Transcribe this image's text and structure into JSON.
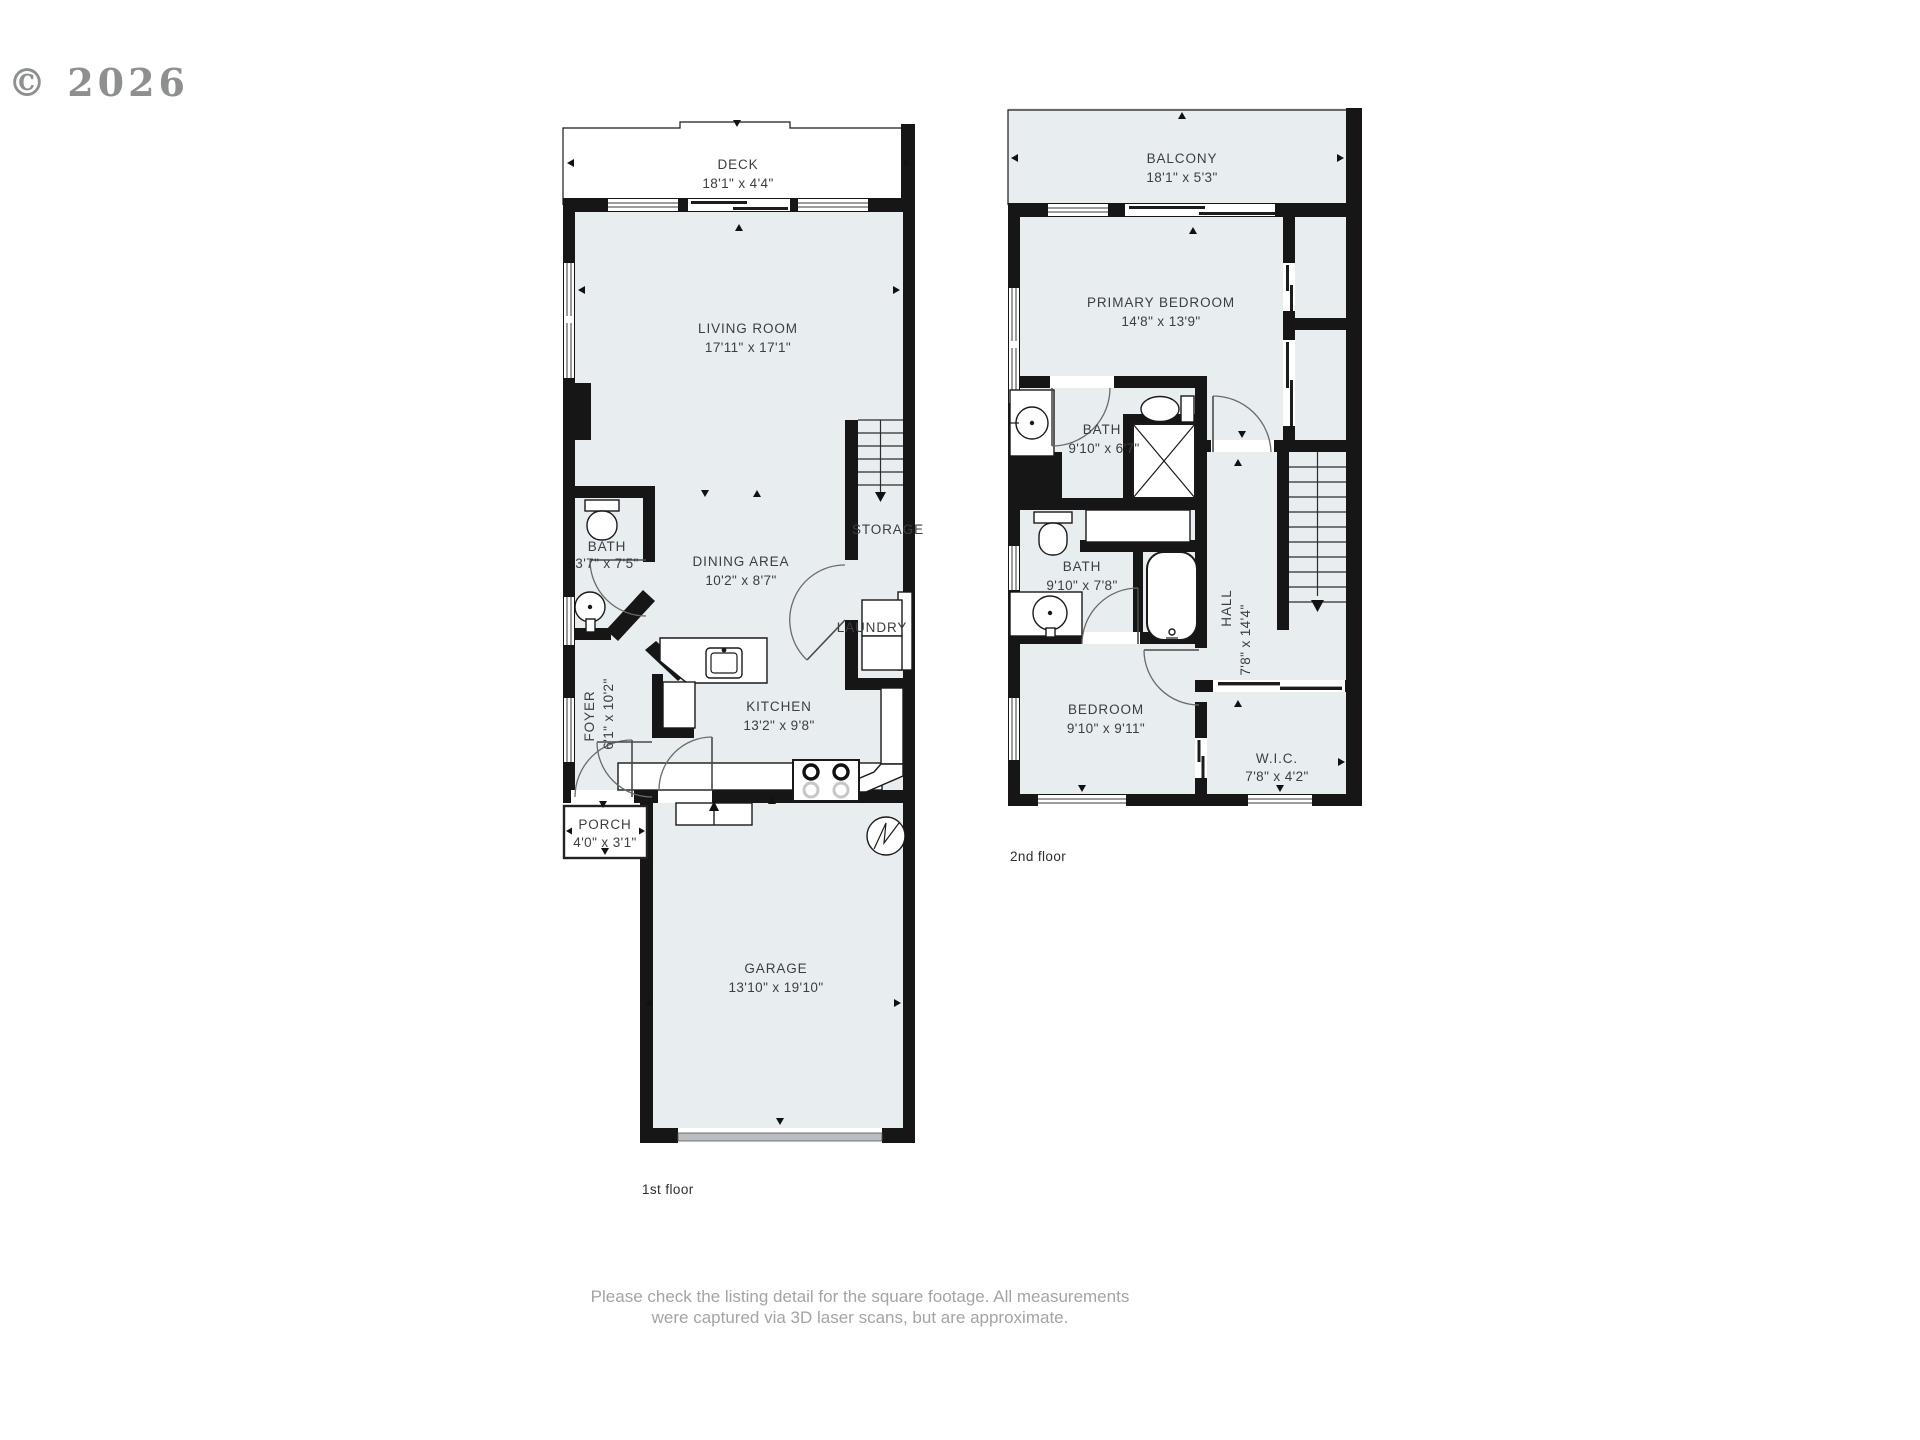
{
  "watermark": "© 2026",
  "colors": {
    "room_fill": "#e8edf0",
    "wall": "#161616",
    "label": "#3b3e42",
    "watermark": "#8d8f90",
    "disclaimer": "#a4a4a4",
    "garage_door": "#b9bdbf"
  },
  "floor1": {
    "caption": "1st floor",
    "rooms": {
      "deck": {
        "name": "DECK",
        "dims": "18'1\" x 4'4\""
      },
      "living": {
        "name": "LIVING ROOM",
        "dims": "17'11\" x 17'1\""
      },
      "bath": {
        "name": "BATH",
        "dims": "3'7\" x 7'5\""
      },
      "dining": {
        "name": "DINING AREA",
        "dims": "10'2\" x 8'7\""
      },
      "storage": {
        "name": "STORAGE"
      },
      "laundry": {
        "name": "LAUNDRY"
      },
      "foyer": {
        "name": "FOYER",
        "dims": "6'1\" x 10'2\""
      },
      "kitchen": {
        "name": "KITCHEN",
        "dims": "13'2\" x 9'8\""
      },
      "porch": {
        "name": "PORCH",
        "dims": "4'0\" x 3'1\""
      },
      "garage": {
        "name": "GARAGE",
        "dims": "13'10\" x 19'10\""
      }
    }
  },
  "floor2": {
    "caption": "2nd floor",
    "rooms": {
      "balcony": {
        "name": "BALCONY",
        "dims": "18'1\" x 5'3\""
      },
      "primary": {
        "name": "PRIMARY BEDROOM",
        "dims": "14'8\" x 13'9\""
      },
      "bath1": {
        "name": "BATH",
        "dims": "9'10\" x 6'7\""
      },
      "bath2": {
        "name": "BATH",
        "dims": "9'10\" x 7'8\""
      },
      "hall": {
        "name": "HALL",
        "dims": "7'8\" x 14'4\""
      },
      "bedroom": {
        "name": "BEDROOM",
        "dims": "9'10\" x 9'11\""
      },
      "wic": {
        "name": "W.I.C.",
        "dims": "7'8\" x 4'2\""
      }
    }
  },
  "disclaimer": {
    "line1": "Please check the listing detail for the square footage. All measurements",
    "line2": "were captured via 3D laser scans, but are approximate."
  }
}
